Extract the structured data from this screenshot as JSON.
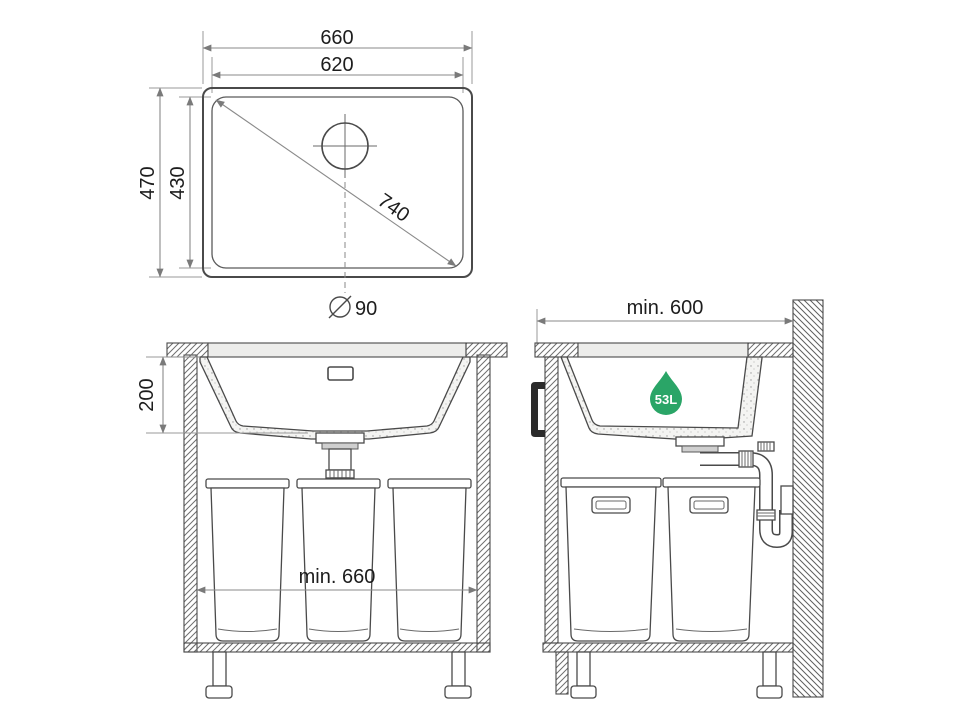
{
  "diagram": {
    "title": "undermount-sink-installation-drawing",
    "top_view": {
      "outer_width": "660",
      "inner_width": "620",
      "outer_depth": "470",
      "inner_depth": "430",
      "diagonal": "740",
      "drain_diameter": "90"
    },
    "front_view": {
      "bowl_depth": "200",
      "min_cabinet_width": "min. 660"
    },
    "side_view": {
      "min_cabinet_depth": "min. 600",
      "capacity": "53L"
    },
    "colors": {
      "capacity_green": "#2aa567",
      "line": "#4a4a4a",
      "dimension": "#8a8a8a",
      "text": "#1d1d1d"
    }
  }
}
